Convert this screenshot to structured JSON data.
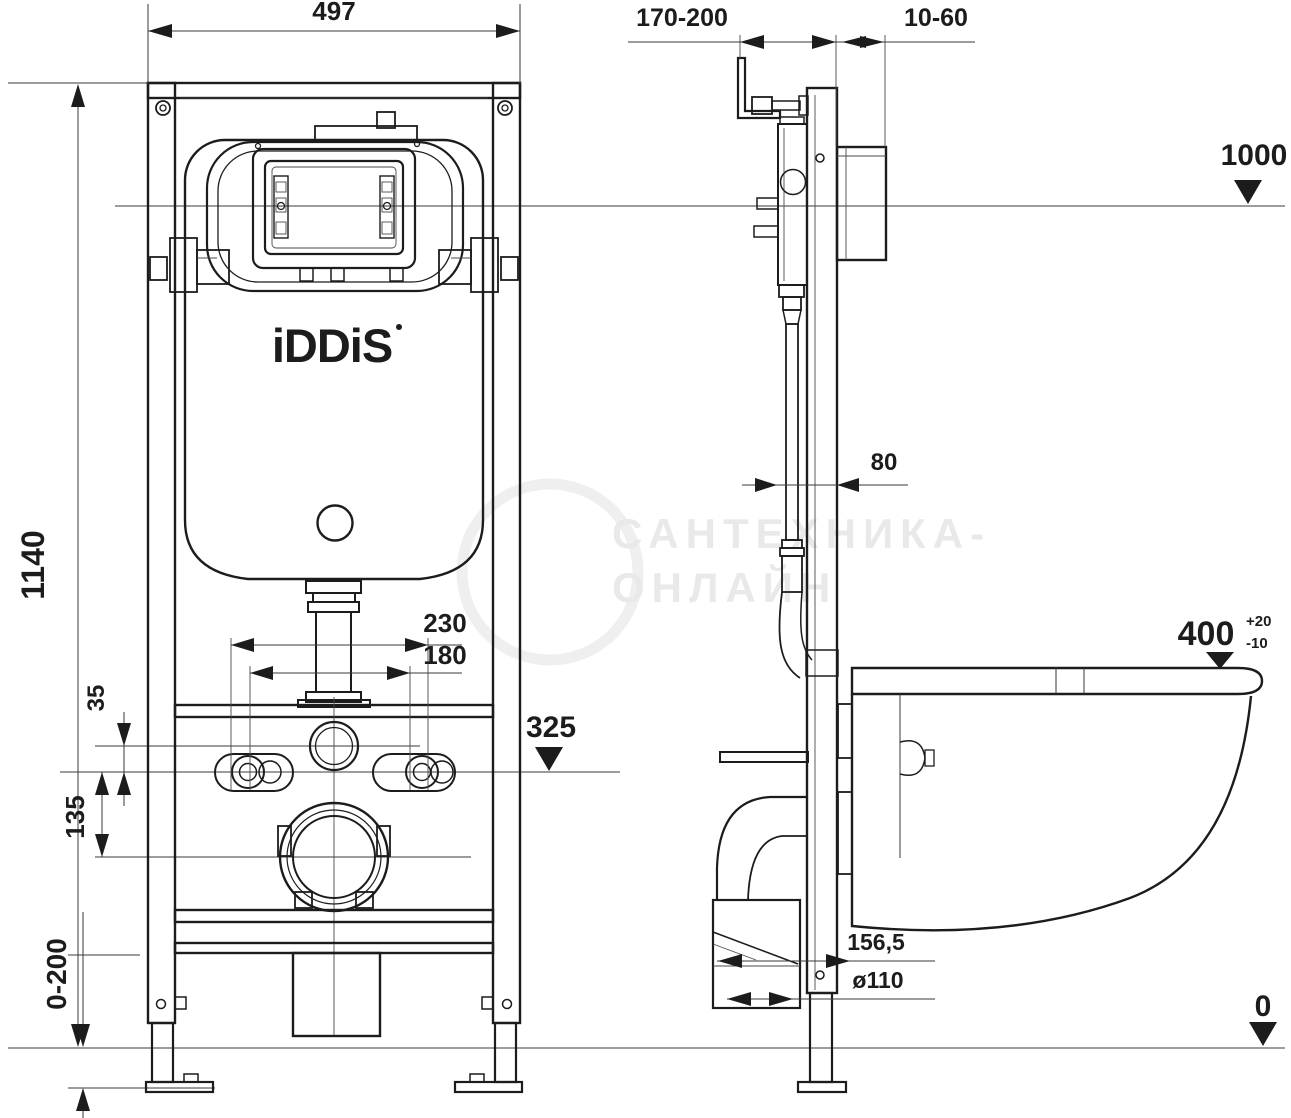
{
  "branding": {
    "logo": "iDDiS",
    "registered_mark": "®"
  },
  "watermark": {
    "line1": "САНТЕХНИКА-",
    "line2": "ОНЛАЙН"
  },
  "front_view": {
    "frame_width": "497",
    "frame_height": "1140",
    "bolt_spacing_max": "230",
    "bolt_spacing_min": "180",
    "water_offset": "35",
    "drain_offset": "135",
    "bolt_level": "325",
    "leg_adjust_range": "0-200"
  },
  "side_view": {
    "install_depth_range": "170-200",
    "wall_finish_range": "10-60",
    "level_top": "1000",
    "profile_depth": "80",
    "seat_height": "400",
    "seat_tolerance_plus": "+20",
    "seat_tolerance_minus": "-10",
    "drain_setback": "156,5",
    "drain_diameter": "ø110",
    "level_zero": "0"
  },
  "colors": {
    "line": "#1c1c1c",
    "watermark": "#e9e9e9",
    "background": "#ffffff"
  }
}
